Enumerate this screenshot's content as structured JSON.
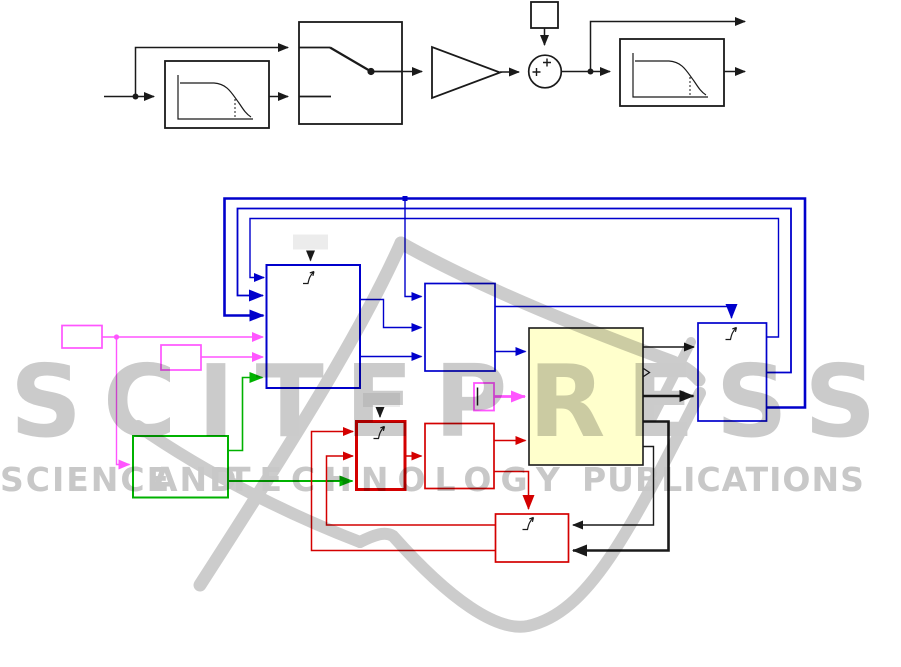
{
  "watermark": {
    "title": "SCITEPRESS",
    "words": [
      "SCIENCE",
      "AND",
      "TECHNOLOGY",
      "PUBLICATIONS"
    ],
    "color": "#c7c7c7"
  },
  "colors": {
    "line_black": "#1a1a1a",
    "signal_blue": "#0000CC",
    "signal_red": "#D40000",
    "signal_green": "#00B200",
    "signal_magenta": "#FF55FF",
    "subsystem_yellow_fill": "#FFFFCC",
    "annotation_gray_fill": "#ECECEC"
  },
  "top_diagram": {
    "description": "black-and-white signal chain",
    "blocks": [
      {
        "name": "lowpass-filter-1",
        "type": "filter-block"
      },
      {
        "name": "manual-switch",
        "type": "switch-block"
      },
      {
        "name": "gain",
        "type": "gain-triangle"
      },
      {
        "name": "constant",
        "type": "small-square"
      },
      {
        "name": "sum",
        "type": "sum-circle",
        "signs": "++"
      },
      {
        "name": "lowpass-filter-2",
        "type": "filter-block"
      }
    ]
  },
  "bottom_diagram": {
    "description": "colored Simulink-style subsystem network with triggered subsystems",
    "blocks": [
      {
        "name": "magenta-source-1",
        "color": "magenta"
      },
      {
        "name": "magenta-source-2",
        "color": "magenta"
      },
      {
        "name": "green-subsystem",
        "color": "green"
      },
      {
        "name": "left-blue-triggered-subsystem",
        "color": "blue",
        "trigger": true
      },
      {
        "name": "middle-blue-subsystem",
        "color": "blue"
      },
      {
        "name": "yellow-plant-subsystem",
        "color": "black",
        "fill": "yellow"
      },
      {
        "name": "magenta-small-block",
        "color": "magenta"
      },
      {
        "name": "right-blue-triggered-subsystem",
        "color": "blue",
        "trigger": true
      },
      {
        "name": "red-triggered-subsystem",
        "color": "red",
        "trigger": true
      },
      {
        "name": "red-subsystem-2",
        "color": "red"
      },
      {
        "name": "red-triggered-subsystem-3",
        "color": "red",
        "trigger": true
      }
    ]
  }
}
